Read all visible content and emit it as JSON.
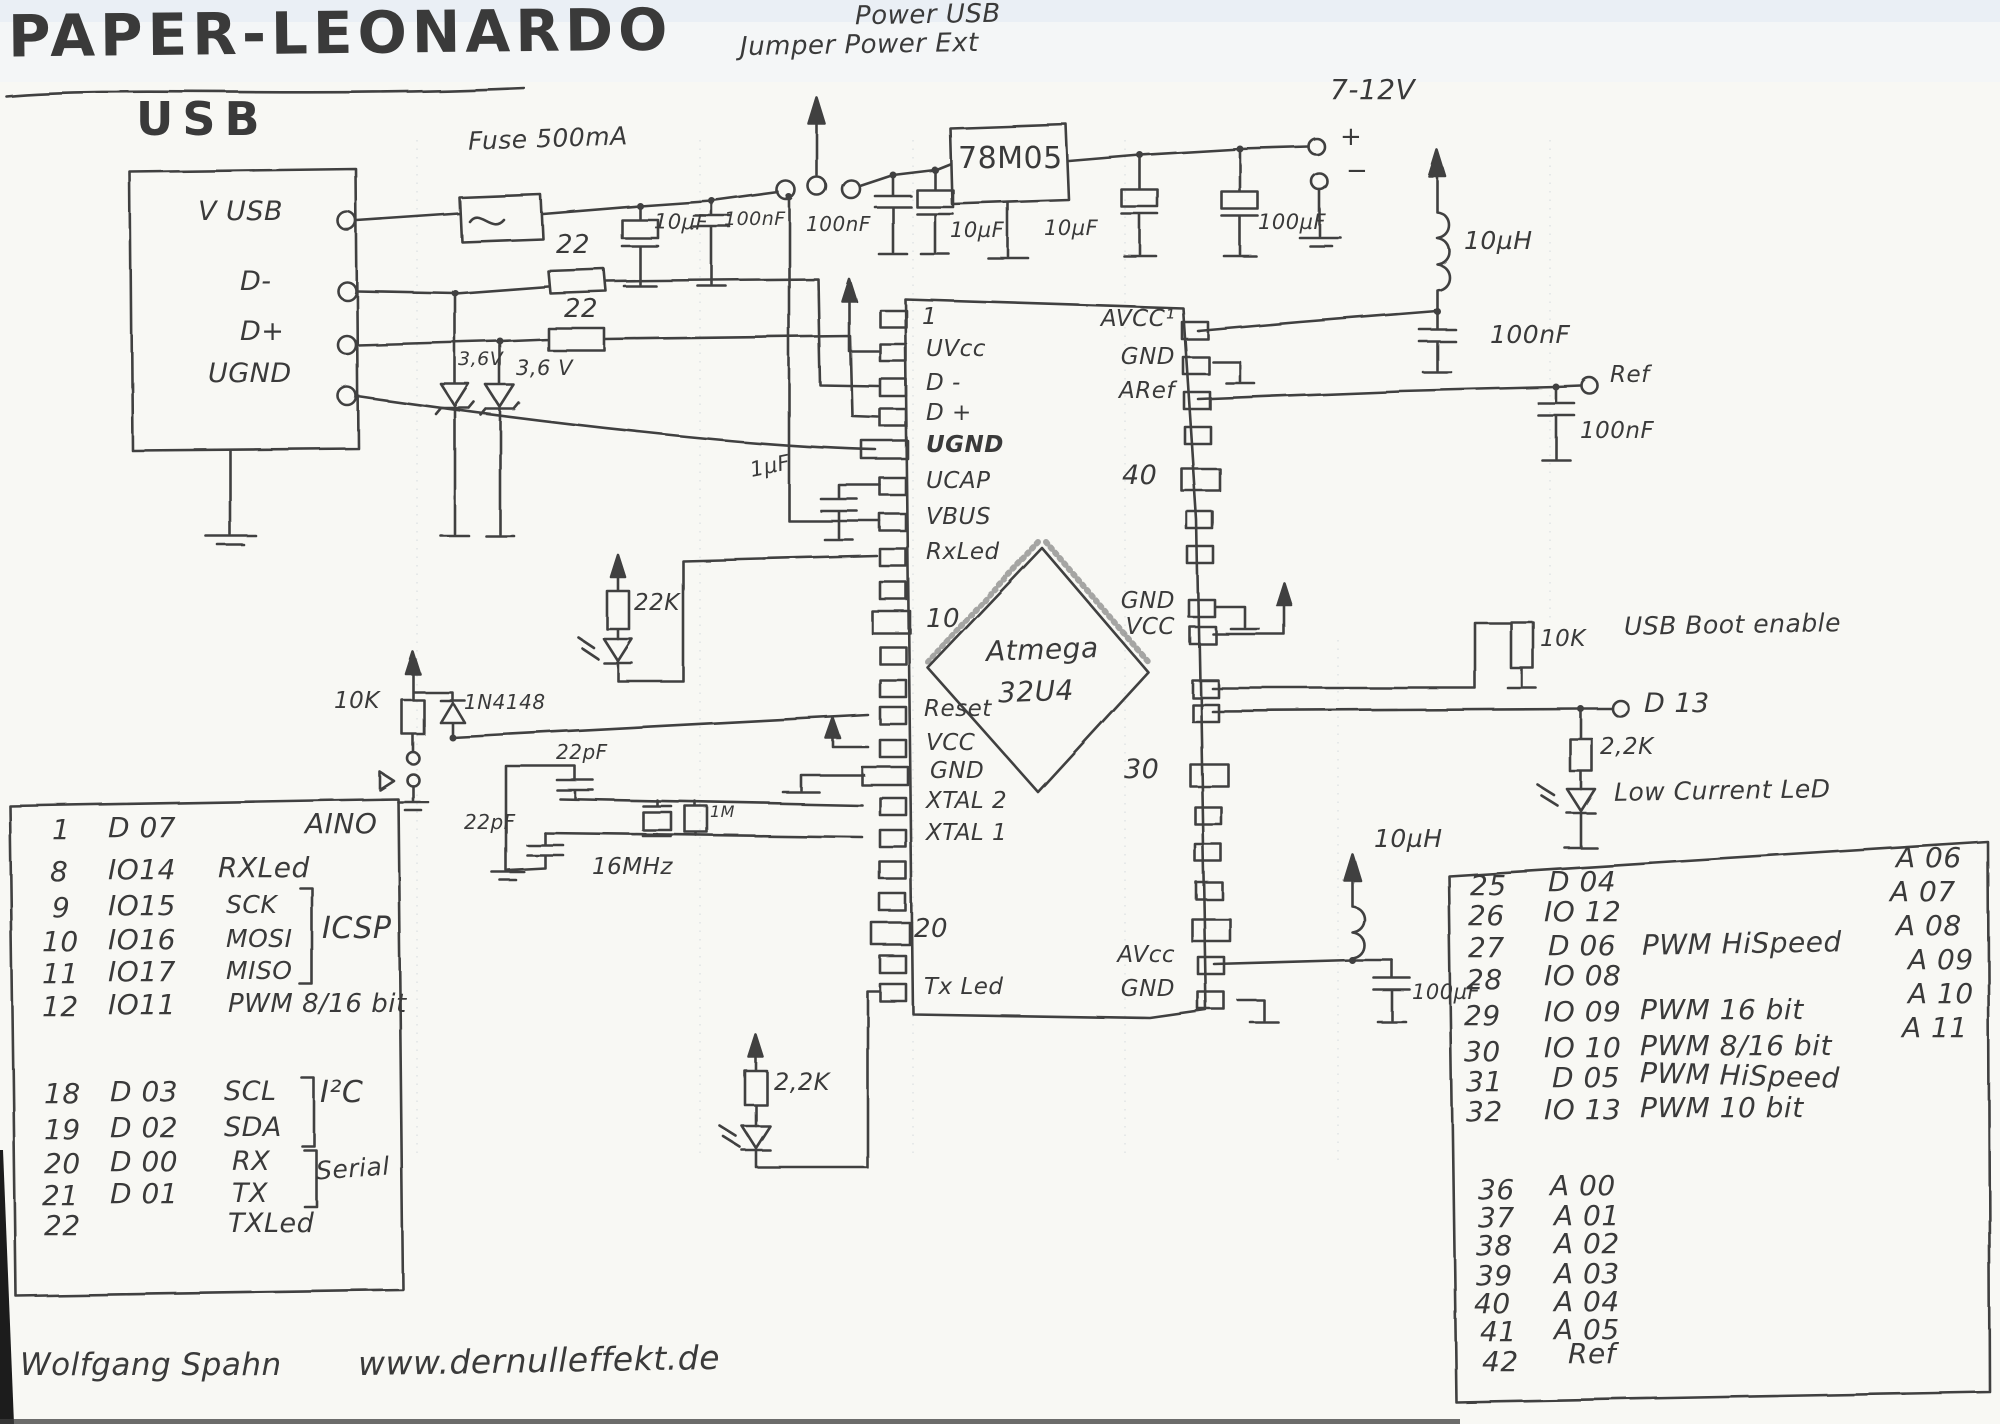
{
  "title": "PAPER-LEONARDO",
  "jumper": {
    "line1": "Power USB",
    "line2": "Jumper Power Ext"
  },
  "usb": {
    "heading": "USB",
    "pin_vusb": "V USB",
    "pin_dm": "D-",
    "pin_dp": "D+",
    "pin_ugnd": "UGND"
  },
  "components": {
    "fuse": "Fuse 500mA",
    "r22_top": "22",
    "r22_bot": "22",
    "zener_left": "3,6V",
    "zener_right": "3,6 V",
    "cap_10uf_1": "10µF",
    "cap_100nf_1": "100nF",
    "cap_100nf_2": "100nF",
    "cap_10uf_2": "10µF",
    "regulator": "78M05",
    "cap_10uf_3": "10µF",
    "cap_100uf_1": "100µF",
    "supply_voltage": "7-12V",
    "plus": "+",
    "minus": "−",
    "ind_10uh_top": "10µH",
    "cap_100nf_3": "100nF",
    "ref_terminal": "Ref",
    "cap_100nf_4": "100nF",
    "r22k_rx": "22K",
    "r10k_reset": "10K",
    "diode_1n4148": "1N4148",
    "cap_1uf": "1µF",
    "cap_22pf_top": "22pF",
    "cap_22pf_bot": "22pF",
    "crystal": "16MHz",
    "r1m": "1M",
    "r10k_boot": "10K",
    "usb_boot": "USB Boot enable",
    "d13": "D 13",
    "r22k_d13": "2,2K",
    "low_current_led": "Low Current LeD",
    "ind_10uh_bot": "10µH",
    "cap_100uf_2": "100µF",
    "r22k_tx": "2,2K"
  },
  "chip": {
    "name1": "Atmega",
    "name2": "32U4",
    "left_pins": [
      "1",
      "UVcc",
      "D -",
      "D +",
      "UGND",
      "UCAP",
      "VBUS",
      "RxLed",
      "10",
      "Reset",
      "VCC",
      "GND",
      "XTAL 2",
      "XTAL 1",
      "20",
      "Tx Led"
    ],
    "right_pins": [
      "AVCC¹",
      "GND",
      "ARef",
      "40",
      "GND",
      "VCC",
      "30",
      "AVcc",
      "GND"
    ]
  },
  "left_table": {
    "rows": [
      {
        "pin": "1",
        "io": "D 07",
        "fn": "",
        "note": "AINO"
      },
      {
        "pin": "8",
        "io": "IO14",
        "fn": "RXLed"
      },
      {
        "pin": "9",
        "io": "IO15",
        "fn": "SCK"
      },
      {
        "pin": "10",
        "io": "IO16",
        "fn": "MOSI"
      },
      {
        "pin": "11",
        "io": "IO17",
        "fn": "MISO"
      },
      {
        "pin": "12",
        "io": "IO11",
        "fn": "PWM 8/16 bit"
      },
      {
        "pin": "18",
        "io": "D 03",
        "fn": "SCL"
      },
      {
        "pin": "19",
        "io": "D 02",
        "fn": "SDA"
      },
      {
        "pin": "20",
        "io": "D 00",
        "fn": "RX"
      },
      {
        "pin": "21",
        "io": "D 01",
        "fn": "TX"
      },
      {
        "pin": "22",
        "io": "",
        "fn": "TXLed"
      }
    ],
    "group_icsp": "ICSP",
    "group_i2c": "I²C",
    "group_serial": "Serial"
  },
  "right_table": {
    "rows": [
      {
        "pin": "25",
        "io": "D 04",
        "fn": ""
      },
      {
        "pin": "26",
        "io": "IO 12",
        "fn": ""
      },
      {
        "pin": "27",
        "io": "D 06",
        "fn": "PWM HiSpeed"
      },
      {
        "pin": "28",
        "io": "IO 08",
        "fn": ""
      },
      {
        "pin": "29",
        "io": "IO 09",
        "fn": "PWM 16 bit"
      },
      {
        "pin": "30",
        "io": "IO 10",
        "fn": "PWM 8/16 bit"
      },
      {
        "pin": "31",
        "io": "D 05",
        "fn": "PWM HiSpeed"
      },
      {
        "pin": "32",
        "io": "IO 13",
        "fn": "PWM 10 bit"
      }
    ],
    "analog": [
      "A 06",
      "A 07",
      "A 08",
      "A 09",
      "A 10",
      "A 11"
    ],
    "rows2": [
      {
        "pin": "36",
        "io": "A 00"
      },
      {
        "pin": "37",
        "io": "A 01"
      },
      {
        "pin": "38",
        "io": "A 02"
      },
      {
        "pin": "39",
        "io": "A 03"
      },
      {
        "pin": "40",
        "io": "A 04"
      },
      {
        "pin": "41",
        "io": "A 05"
      },
      {
        "pin": "42",
        "io": ""
      }
    ],
    "ref": "Ref"
  },
  "footer": {
    "author": "Wolfgang Spahn",
    "website": "www.dernulleffekt.de"
  }
}
